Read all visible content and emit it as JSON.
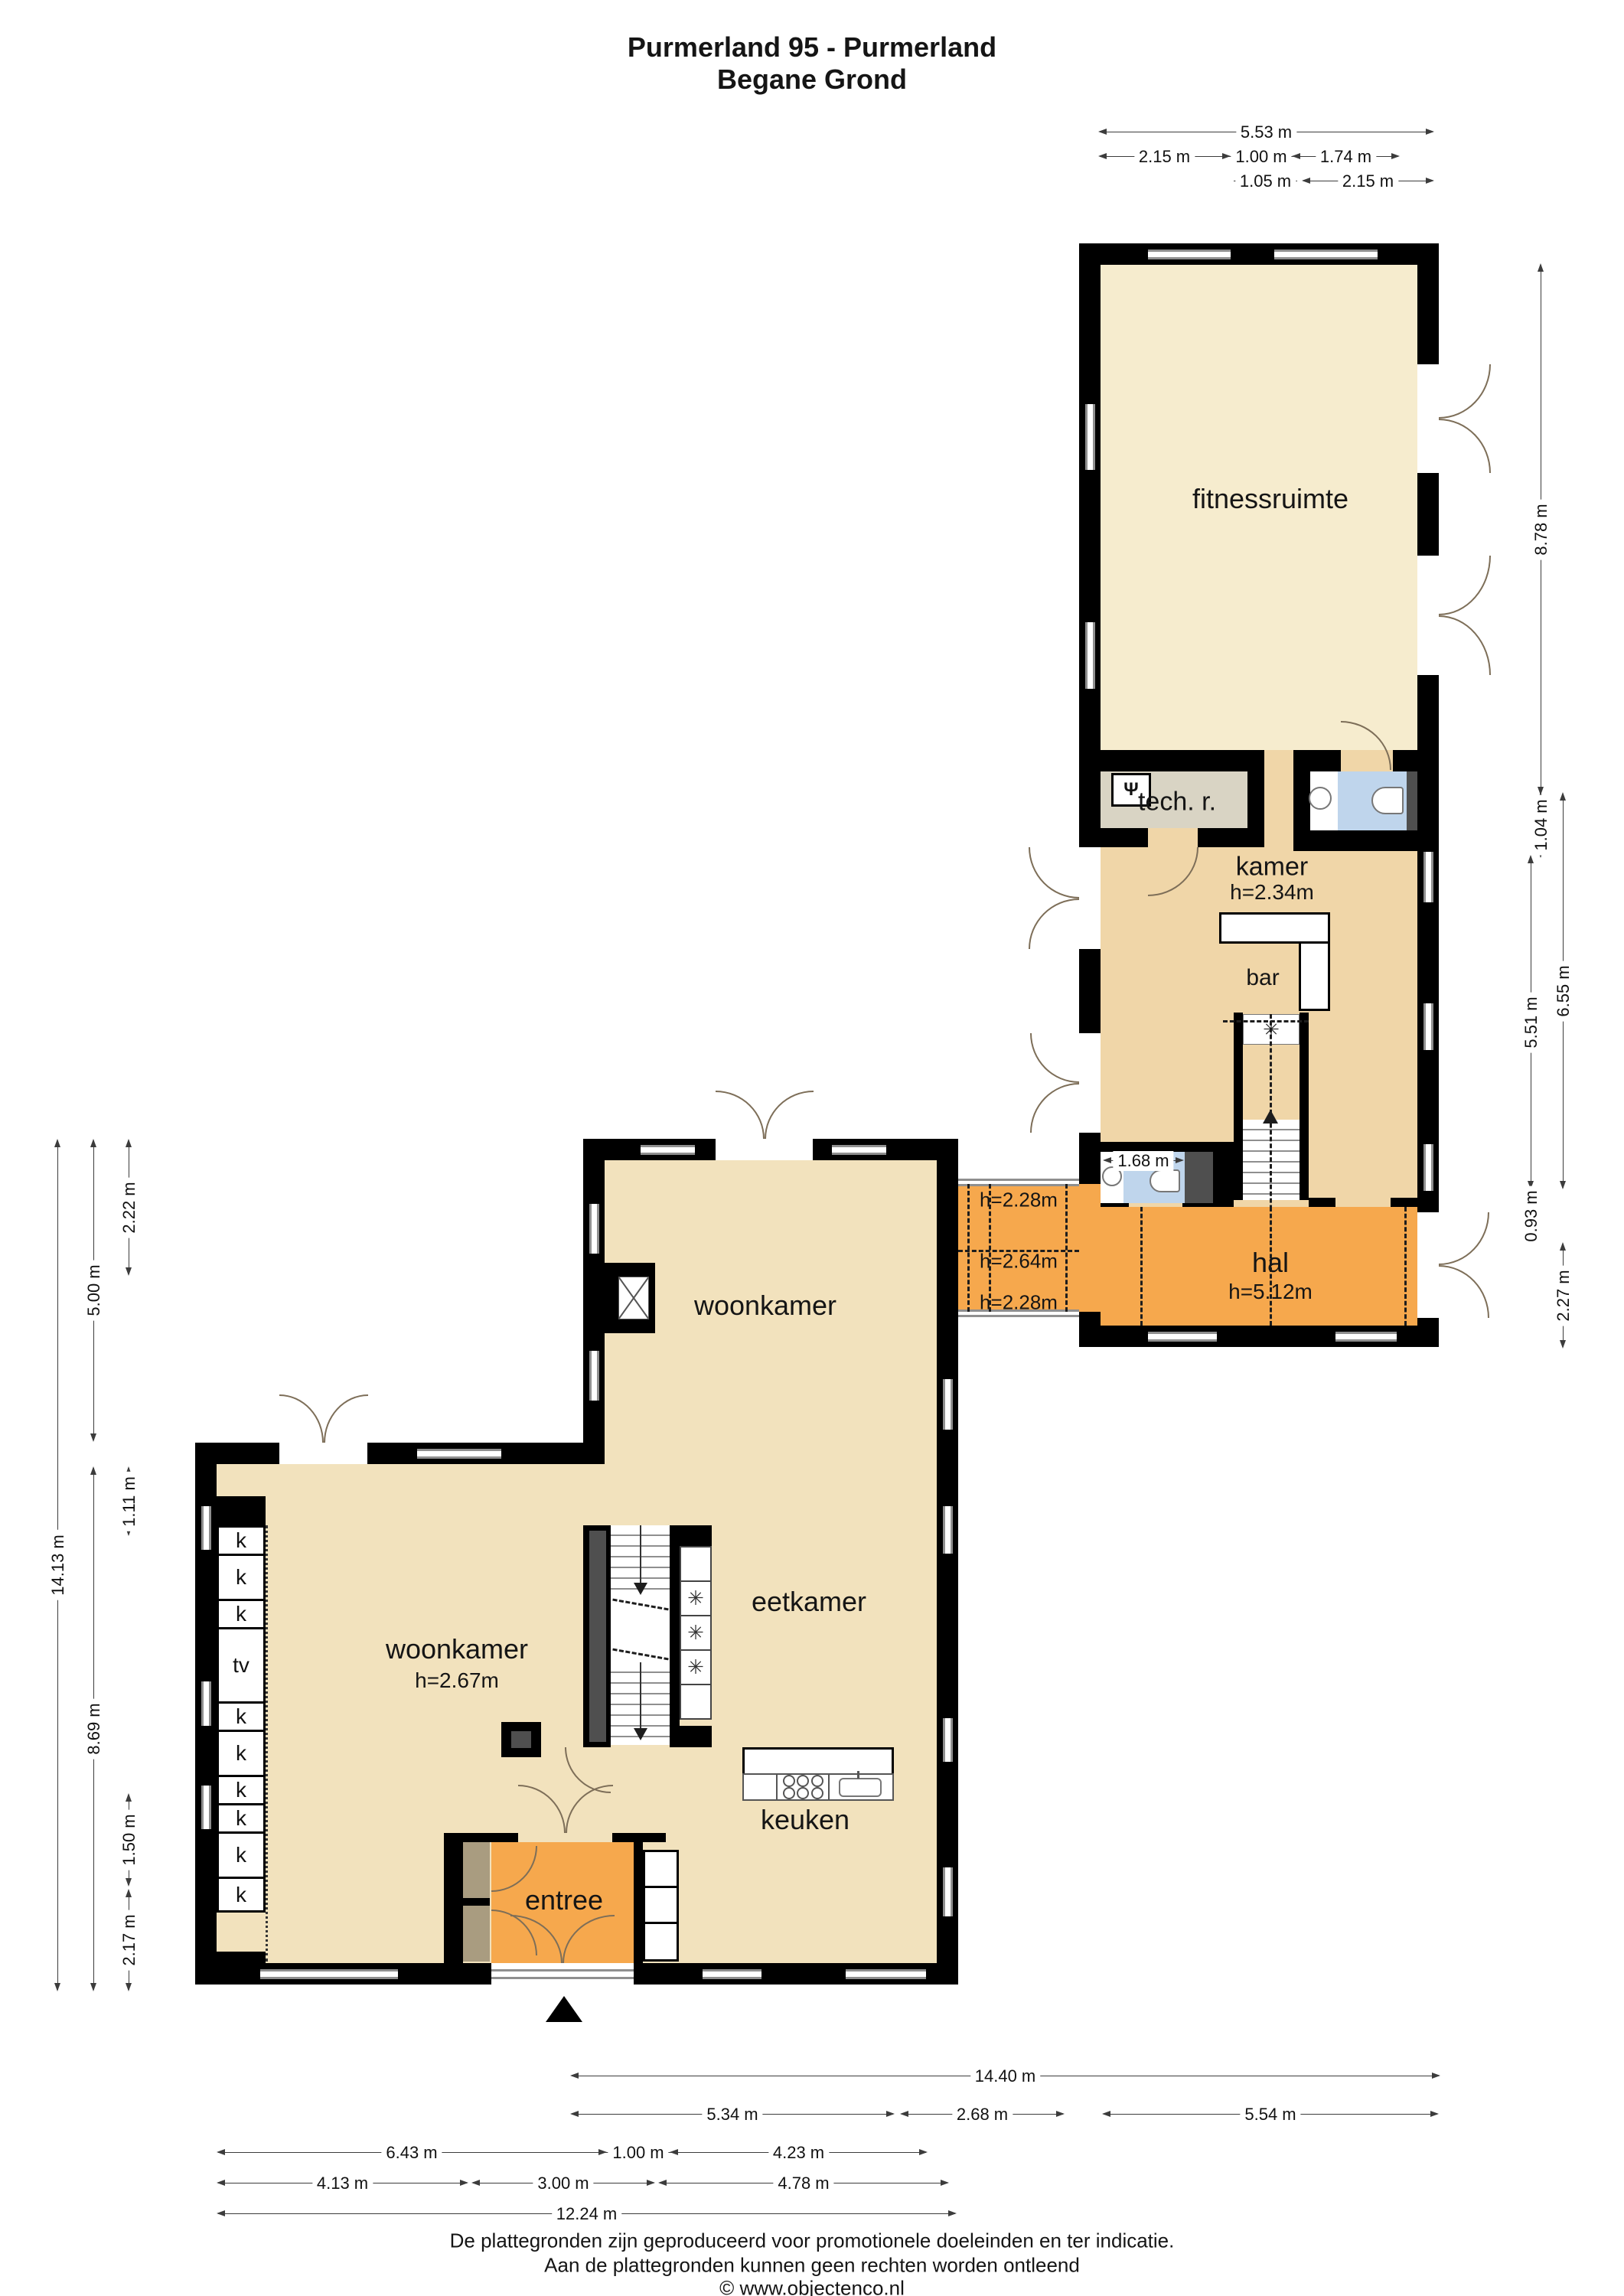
{
  "title": {
    "line1": "Purmerland 95 - Purmerland",
    "line2": "Begane Grond"
  },
  "rooms": {
    "fitnessruimte": "fitnessruimte",
    "tech_r": "tech. r.",
    "kamer": "kamer",
    "kamer_height": "h=2.34m",
    "bar": "bar",
    "hal": "hal",
    "hal_height": "h=5.12m",
    "corridor_top": "h=2.28m",
    "corridor_mid": "h=2.64m",
    "corridor_bottom": "h=2.28m",
    "woonkamer_upper": "woonkamer",
    "woonkamer": "woonkamer",
    "woonkamer_height": "h=2.67m",
    "eetkamer": "eetkamer",
    "keuken": "keuken",
    "entree": "entree"
  },
  "closets": [
    "k",
    "k",
    "k",
    "tv",
    "k",
    "k",
    "k",
    "k",
    "k",
    "k"
  ],
  "icons": {
    "fan": "✳",
    "boiler": "Ψ",
    "arrow_up": "▲",
    "arrow_down": "▼"
  },
  "dims": {
    "top": [
      "5.53 m",
      "2.15 m",
      "1.00 m",
      "1.74 m",
      "1.05 m",
      "2.15 m"
    ],
    "right": [
      "8.78 m",
      "1.04 m",
      "5.51 m",
      "6.55 m",
      "0.93 m",
      "2.27 m"
    ],
    "left": [
      "14.13 m",
      "5.00 m",
      "8.69 m",
      "2.22 m",
      "1.11 m",
      "1.50 m",
      "2.17 m"
    ],
    "bottom": [
      "14.40 m",
      "5.34 m",
      "2.68 m",
      "5.54 m",
      "6.43 m",
      "1.00 m",
      "4.23 m",
      "4.13 m",
      "3.00 m",
      "4.78 m",
      "12.24 m"
    ],
    "wc": "1.68 m"
  },
  "footer": {
    "line1": "De plattegronden zijn geproduceerd voor promotionele doeleinden en ter indicatie.",
    "line2": "Aan de plattegronden kunnen geen rechten worden ontleend",
    "line3": "© www.objectenco.nl"
  },
  "colors": {
    "wall": "#000000",
    "floor_light": "#f6ecce",
    "floor_tan": "#f0d6a8",
    "floor_beige": "#f2e2bd",
    "floor_orange": "#f6a84d",
    "floor_blue": "#bfd5ec",
    "floor_tech": "#d9d4c4",
    "closet_khaki": "#a99c80",
    "shaft_gray": "#4f4f4f"
  }
}
